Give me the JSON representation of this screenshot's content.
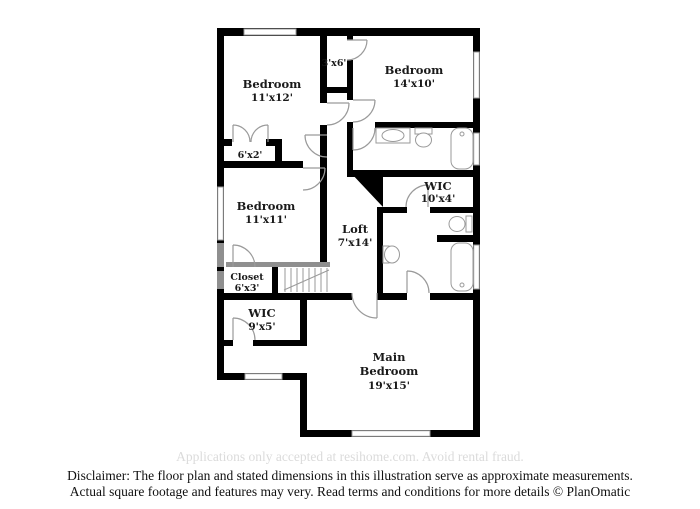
{
  "colors": {
    "wall": "#000000",
    "half_wall": "#8f8f8f",
    "fixture_outline": "#9a9a9a",
    "label_text": "#1a1a1a",
    "watermark_text": "#dbdbdb",
    "background": "#ffffff"
  },
  "rooms": {
    "bedroom_top_left": {
      "label": "Bedroom",
      "dims": "11'x12'"
    },
    "closet_top": {
      "dims": "3'x6'"
    },
    "bedroom_top_right": {
      "label": "Bedroom",
      "dims": "14'x10'"
    },
    "closet_left": {
      "dims": "6'x2'"
    },
    "bedroom_mid_left": {
      "label": "Bedroom",
      "dims": "11'x11'"
    },
    "wic_right": {
      "label": "WIC",
      "dims": "10'x4'"
    },
    "loft": {
      "label": "Loft",
      "dims": "7'x14'"
    },
    "closet_mid": {
      "label": "Closet",
      "dims": "6'x3'"
    },
    "wic_left": {
      "label": "WIC",
      "dims": "9'x5'"
    },
    "main_bedroom": {
      "label_line1": "Main",
      "label_line2": "Bedroom",
      "dims": "19'x15'"
    }
  },
  "watermark": "Applications only accepted at resihome.com. Avoid rental fraud.",
  "disclaimer": {
    "line1": "Disclaimer: The floor plan and stated dimensions in this illustration serve as approximate measurements.",
    "line2": "Actual square footage and features may very. Read terms and conditions for more details © PlanOmatic"
  }
}
